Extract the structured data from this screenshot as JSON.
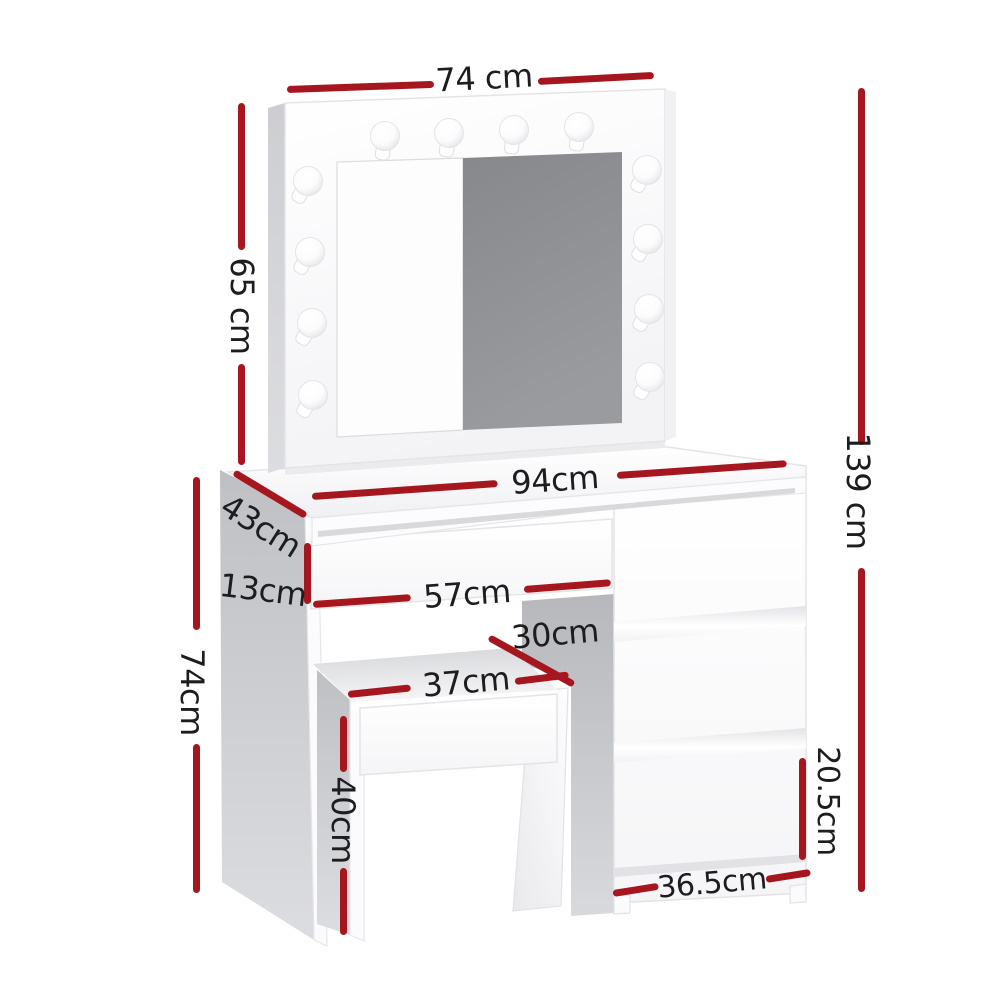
{
  "page": {
    "background": "#ffffff"
  },
  "colors": {
    "dimension_line": "#a6161f",
    "label_text": "#1d1d1f",
    "mirror_glass": "#8e8f92",
    "panel_gray": "#c9cacc",
    "furniture_white": "#fbfbfd"
  },
  "bulbs": {
    "icon": "light-bulb-icon",
    "count": 12
  },
  "dims": {
    "mirror_width": "74 cm",
    "mirror_height": "65 cm",
    "total_height": "139 cm",
    "table_width": "94cm",
    "table_depth": "43cm",
    "drawer_height": "13cm",
    "knee_space_width": "57cm",
    "stool_depth": "30cm",
    "stool_width": "37cm",
    "table_height": "74cm",
    "stool_height": "40cm",
    "bottom_drawer_height": "20.5cm",
    "drawer_unit_width": "36.5cm"
  }
}
